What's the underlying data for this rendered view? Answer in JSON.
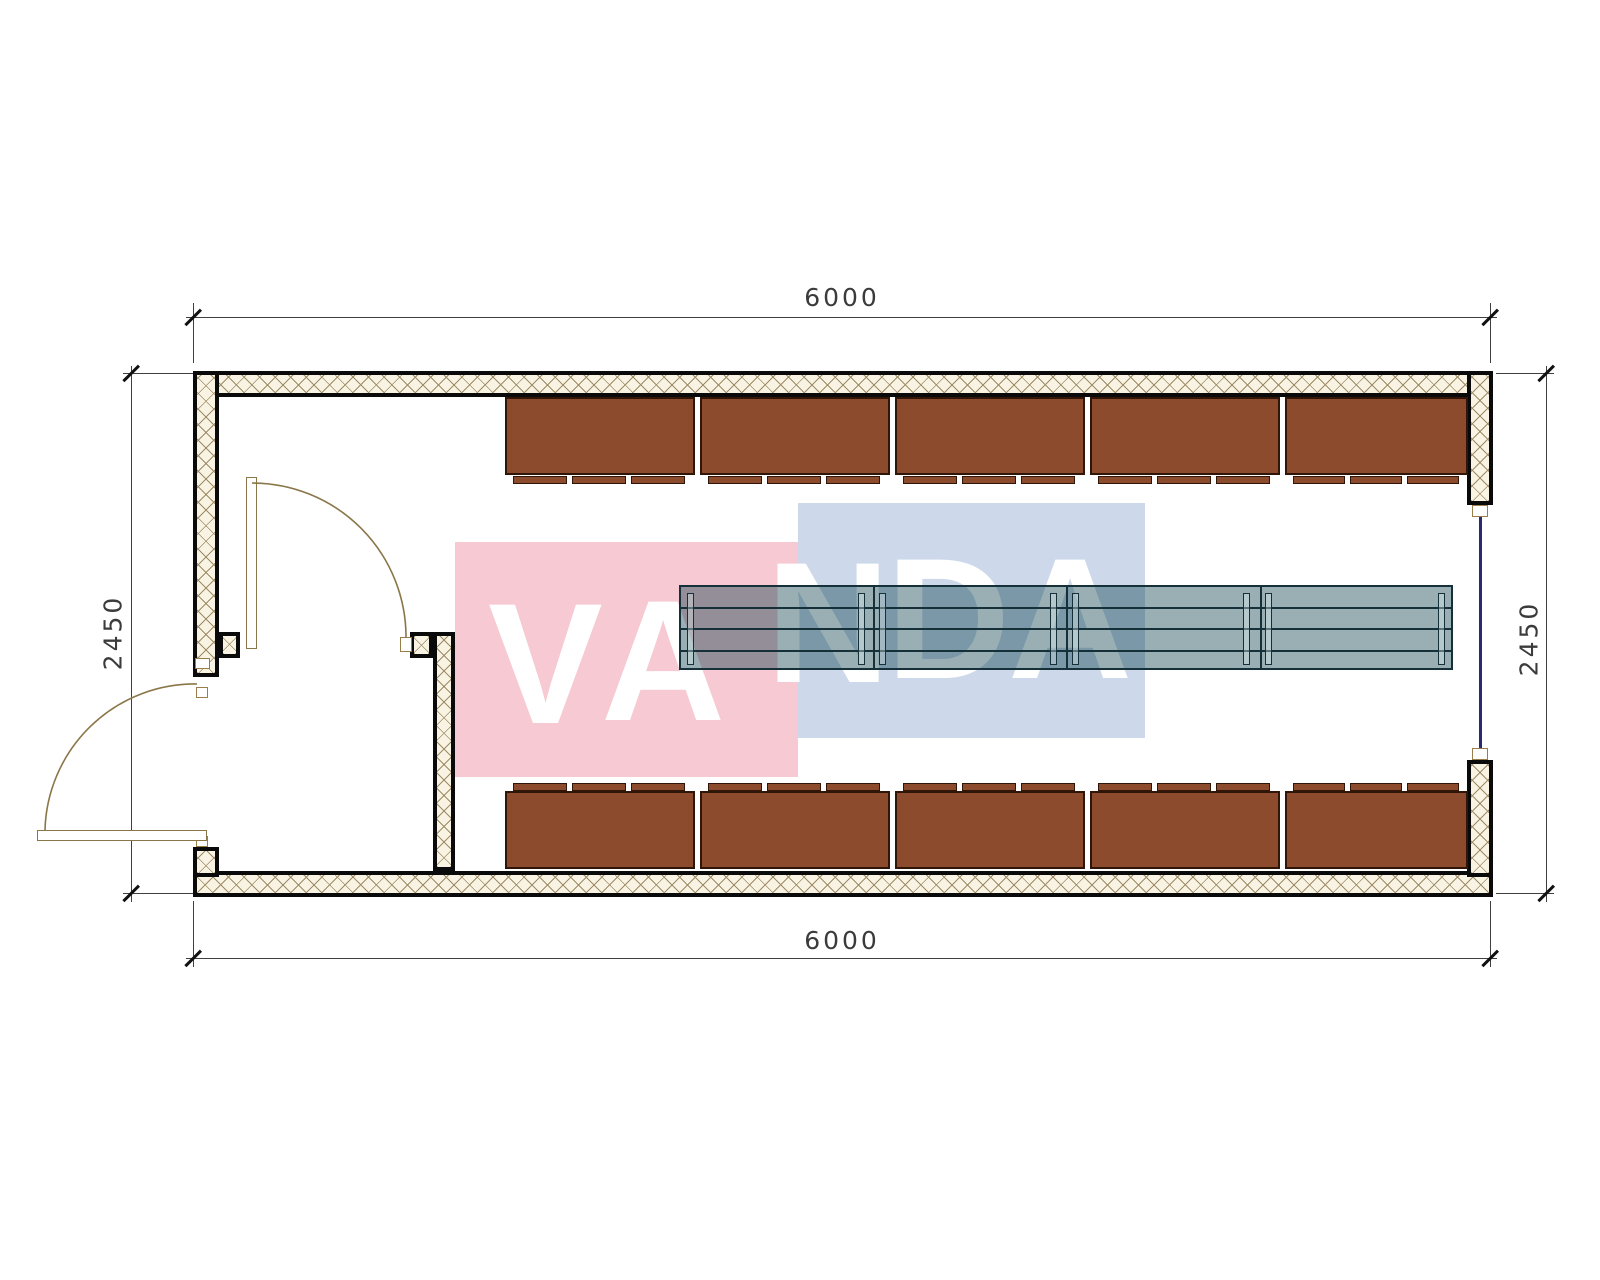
{
  "title": "container-floor-plan",
  "dimensions": {
    "top": "6000",
    "bottom": "6000",
    "left": "2450",
    "right": "2450"
  },
  "watermark": {
    "text": "VANDA",
    "pink_color": "#f7c9d2",
    "blue_color": "#cdd9eb",
    "text_color": "#ffffff"
  },
  "furniture": {
    "cabinet_rows": [
      {
        "id": "top",
        "units": 5
      },
      {
        "id": "bottom",
        "units": 5
      }
    ],
    "cabinet_color": "#8c4b2c",
    "table_sections": 4,
    "table_fill": "rgba(0,55,68,0.40)"
  },
  "walls": {
    "hatch_base": "#f8f3e3",
    "hatch_line": "#9d8c66",
    "outline": "#0a0a0a"
  }
}
